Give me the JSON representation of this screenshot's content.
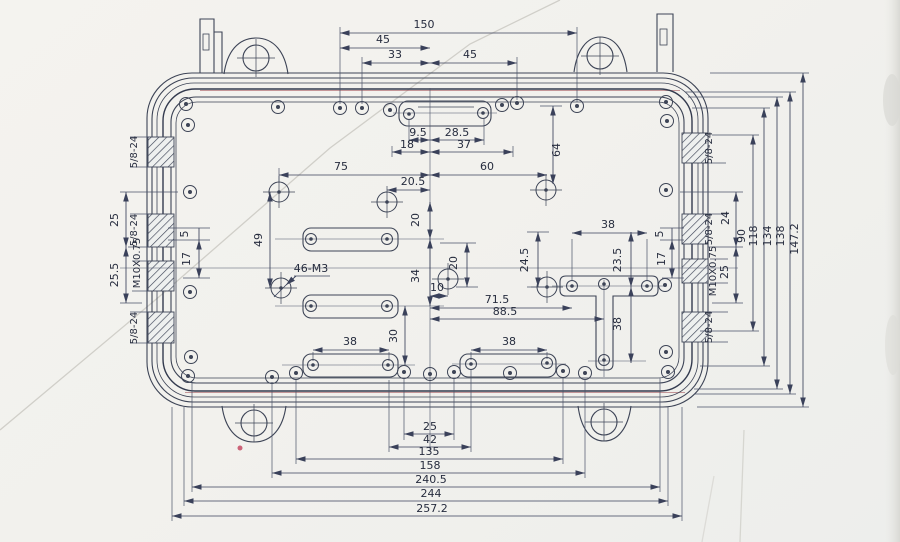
{
  "drawing": {
    "dims": {
      "top": {
        "overall": "150",
        "left": "45",
        "mid": "33",
        "right": "45"
      },
      "top_slot": {
        "a": "9.5",
        "b": "28.5",
        "c": "18",
        "d": "37"
      },
      "upper": {
        "left": "75",
        "right": "60",
        "drop": "64",
        "offset": "20.5"
      },
      "mid": {
        "v20": "20",
        "v34": "34",
        "v49": "49",
        "callout": "46-M3",
        "h10": "10",
        "v20b": "20",
        "v245": "24.5",
        "v235": "23.5",
        "h715": "71.5",
        "h885": "88.5",
        "t38": "38",
        "t38v": "38",
        "v30": "30",
        "slot_l": "38",
        "slot_r": "38"
      },
      "left": {
        "a25": "25",
        "a255": "25.5",
        "a5": "5",
        "a17": "17"
      },
      "right": {
        "a5": "5",
        "a17": "17",
        "a24": "24",
        "a25": "25",
        "a90": "90",
        "a118": "118",
        "a134": "134",
        "a138": "138",
        "a1472": "147.2"
      },
      "bottom": {
        "a": "25",
        "b": "42",
        "c": "135",
        "d": "158",
        "e": "240.5",
        "f": "244",
        "g": "257.2"
      }
    },
    "threads": {
      "l1": "5/8-24",
      "l2": "5/8-24",
      "l3": "M10X0.75",
      "l4": "5/8-24",
      "r1": "5/8-24",
      "r2": "5/8-24",
      "r3": "M10X0.75",
      "r4": "5/8-24"
    },
    "colors": {
      "ink": "#3d4456",
      "dim_ink": "#3a415a",
      "text_ink": "#262c3e",
      "paper": "#f2f1ed",
      "red_artifact": "#9e4a52"
    }
  }
}
